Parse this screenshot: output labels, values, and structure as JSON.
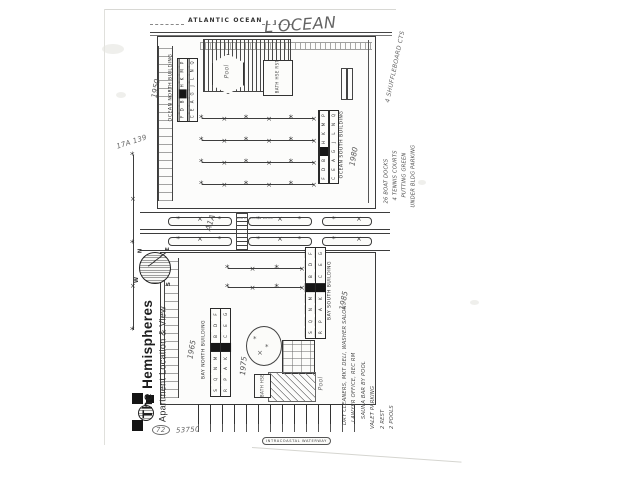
{
  "page": {
    "title": "The Hemispheres",
    "subtitle": "Apartment Location & View"
  },
  "water": {
    "ocean_label": "ATLANTIC OCEAN",
    "intracoastal_label": "INTRACOASTAL WATERWAY"
  },
  "roads": {
    "a1a_handwritten": "A1A",
    "road_small_label": "SOUTH OCEAN DRIVE"
  },
  "compass": {
    "n": "N",
    "e": "E",
    "s": "S",
    "w": "W"
  },
  "buildings": {
    "ocean_north": {
      "label": "OCEAN NORTH BUILDING",
      "year": "1950",
      "row1": [
        "F",
        "D",
        "B",
        "■",
        "H",
        "K",
        "M",
        "P"
      ],
      "row2": [
        "C",
        "E",
        "A",
        "G",
        "J",
        "L",
        "N",
        "Q"
      ]
    },
    "ocean_south": {
      "label": "OCEAN SOUTH BUILDING",
      "year": "1980",
      "row1": [
        "F",
        "D",
        "B",
        "■",
        "H",
        "K",
        "M",
        "P"
      ],
      "row2": [
        "C",
        "E",
        "A",
        "G",
        "J",
        "L",
        "N",
        "Q"
      ]
    },
    "bay_north": {
      "label": "BAY NORTH BUILDING",
      "year": "1965",
      "row1": [
        "S",
        "Q",
        "N",
        "M",
        "■",
        "B",
        "D",
        "F"
      ],
      "row2": [
        "R",
        "P",
        "A",
        "K",
        "■",
        "C",
        "E",
        "G"
      ]
    },
    "bay_south": {
      "label": "BAY SOUTH BUILDING",
      "year": "1985",
      "row1": [
        "S",
        "Q",
        "N",
        "M",
        "■",
        "B",
        "D",
        "F"
      ],
      "row2": [
        "R",
        "P",
        "A",
        "K",
        "■",
        "C",
        "E",
        "G"
      ]
    }
  },
  "features": {
    "ocean_pool_label": "Pool",
    "bay_pool_label": "Pool",
    "ocean_bath_house": "BATH HSE RST",
    "bay_bath_house": "BATH HSE"
  },
  "annotations": {
    "ocean_script": "L'OCEAN",
    "shuffleboard_note": "4 SHUFFLEBOARD CTS",
    "plat_note": "17A 139",
    "bay_pool_year": "1975",
    "dock_note_oval": "72",
    "dock_note_number": "53750",
    "amenities_right": [
      "26 BOAT DOCKS",
      "4 TENNIS COURTS",
      "PUTTING GREEN",
      "UNDER BLDG PARKING"
    ],
    "amenities_bottom": [
      "DRY CLEANERS, MKT DELI, WASHER SALON",
      "LAWYER OFFICE, REC RM",
      "SAUNA BAR BY POOL",
      "VALET PARKING",
      "2 REST",
      "2 POOLS"
    ]
  }
}
